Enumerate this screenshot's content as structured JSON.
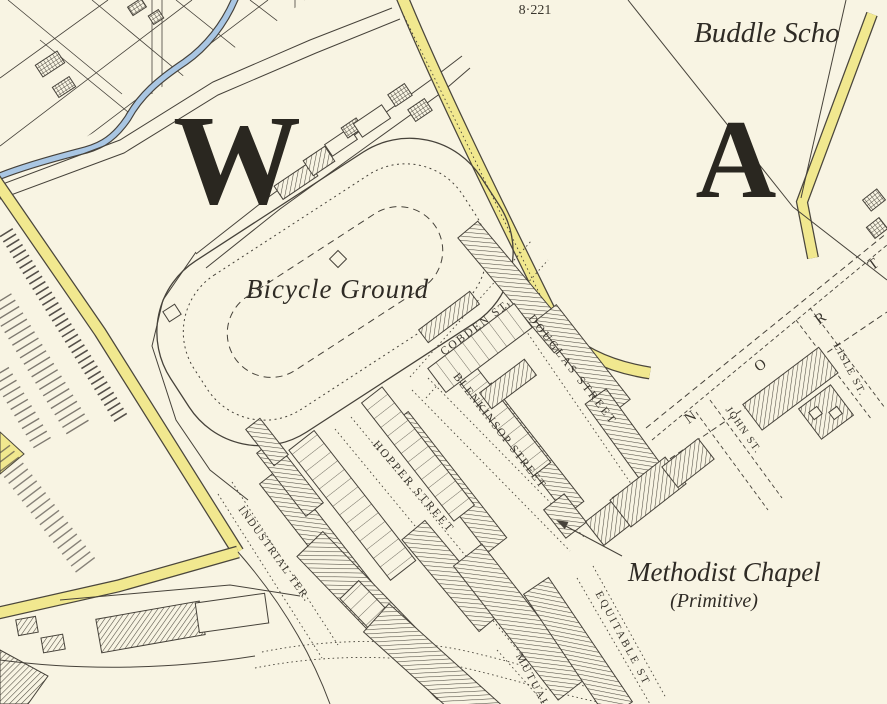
{
  "map": {
    "sheet_number": "8·221",
    "labels": {
      "buddle_school": "Buddle Scho",
      "district_letter_w": "W",
      "district_letter_a": "A",
      "bicycle_ground": "Bicycle Ground",
      "methodist_chapel": "Methodist Chapel",
      "methodist_chapel_qualifier": "(Primitive)"
    },
    "streets": {
      "cobden": "COBDEN ST.",
      "douglas": "DOUGLAS STREET",
      "blenkinsop": "BLENKINSOP STREET",
      "hopper": "HOPPER STREET",
      "industrial": "INDUSTRIAL TER.",
      "equitable": "EQUITABLE ST",
      "mutual": "MUTUAL ST",
      "john": "JOHN ST.",
      "lisle": "LISLE ST.",
      "north_road_letters": [
        "N",
        "O",
        "R",
        "T"
      ]
    },
    "colors": {
      "background": "#f8f4e3",
      "road_highlight": "#f1e88f",
      "water": "#a9c6e3",
      "ink": "#46423a"
    }
  }
}
